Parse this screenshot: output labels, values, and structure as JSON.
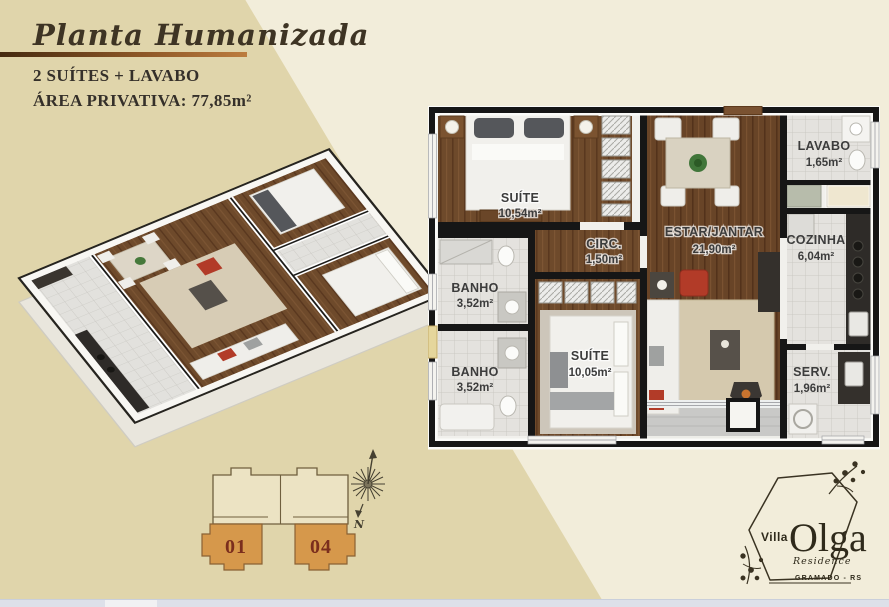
{
  "header": {
    "title": "Planta Humanizada",
    "features": "2 SUÍTES + LAVABO",
    "private_area": "ÁREA PRIVATIVA: 77,85m²"
  },
  "floorplan_2d": {
    "rooms": [
      {
        "name": "SUÍTE",
        "area": "10,54m²"
      },
      {
        "name": "CIRC.",
        "area": "1,50m²"
      },
      {
        "name": "ESTAR/JANTAR",
        "area": "21,90m²"
      },
      {
        "name": "LAVABO",
        "area": "1,65m²"
      },
      {
        "name": "COZINHA",
        "area": "6,04m²"
      },
      {
        "name": "BANHO",
        "area": "3,52m²"
      },
      {
        "name": "BANHO",
        "area": "3,52m²"
      },
      {
        "name": "SUÍTE",
        "area": "10,05m²"
      },
      {
        "name": "SERV.",
        "area": "1,96m²"
      }
    ]
  },
  "key_plan": {
    "units": [
      {
        "number": "01"
      },
      {
        "number": "04"
      }
    ]
  },
  "compass": {
    "north_label": "N"
  },
  "logo": {
    "brand_small": "Villa",
    "brand_large": "Olga",
    "brand_sub": "Residence",
    "location": "GRAMADO - RS"
  },
  "colors": {
    "background_tan": "#e0d5ab",
    "background_cream": "#f2edda",
    "accent_bar_start": "#452a10",
    "accent_bar_end": "#bc7c3e",
    "unit_highlight": "#d6984b",
    "unit_number": "#7b2e1d",
    "wall": "#161616",
    "wood_floor": "#6e4a2b",
    "tile_floor": "#e4e2de"
  }
}
